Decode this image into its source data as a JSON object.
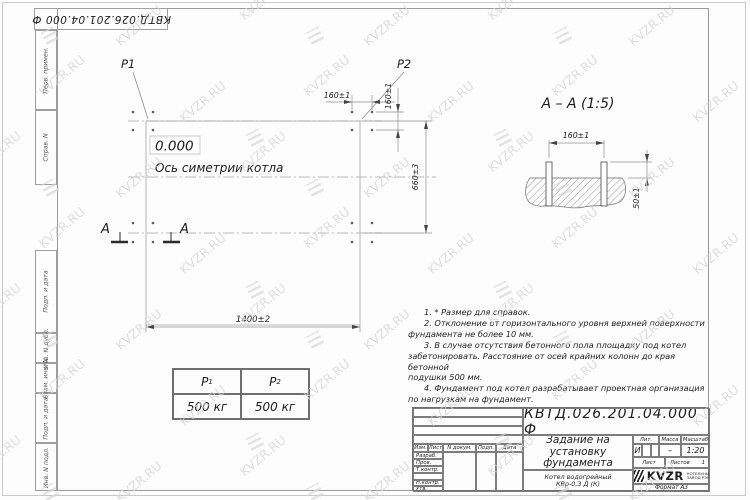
{
  "sheet": {
    "stamp_top": "КВТД.026.201.04.000  Ф",
    "watermark_text": "KVZR.RU"
  },
  "margin": {
    "items": [
      {
        "label": "Перв. примен."
      },
      {
        "label": "Справ. N"
      },
      {
        "label": "Подп. и дата"
      },
      {
        "label": "Инв. N дубл."
      },
      {
        "label": "Взам. инв. N"
      },
      {
        "label": "Подп. и дата"
      },
      {
        "label": "Инв. N подл."
      }
    ]
  },
  "plan": {
    "p1_label": "P1",
    "p2_label": "P2",
    "level_mark": "0.000",
    "axis_label": "Ось симетрии котла",
    "dim_width": "1400±2",
    "dim_height": "660±3",
    "dim_bolt_top": "160±1",
    "dim_bolt_side": "160±1",
    "section_letter": "A"
  },
  "section": {
    "title": "А – А (1:5)",
    "dim_spacing": "160±1",
    "dim_protrusion": "50±1"
  },
  "notes": {
    "lines": [
      "1. * Размер для справок.",
      "2. Отклонение от горизонтального уровня верхней поверхности",
      "фундамента не более 10 мм.",
      "3. В случае отсутствия бетонного пола площадку под котел",
      "забетонировать. Расстояние от осей крайних колонн до края бетонной",
      "подушки 500 мм.",
      "4. Фундамент под котел разрабатывает проектная организация",
      "по нагрузкам на фундамент."
    ]
  },
  "load_table": {
    "col1_base": "P",
    "col1_sub": "1",
    "col2_base": "P",
    "col2_sub": "2",
    "col1_value": "500 кг",
    "col2_value": "500 кг"
  },
  "title_block": {
    "designation": "КВТД.026.201.04.000  Ф",
    "doc_title_line1": "Задание на",
    "doc_title_line2": "установку",
    "doc_title_line3": "фундамента",
    "product_line1": "Котел водогрейный",
    "product_line2": "КВр-0,3 Д (К)",
    "col_izm": "Изм.",
    "col_list": "Лист",
    "col_ndoc": "N докум.",
    "col_podp": "Подп.",
    "col_data": "Дата",
    "row_razrab": "Разраб.",
    "row_prov": "Пров.",
    "row_tkontr": "Т.контр.",
    "row_nkontr": "Н.контр.",
    "row_utv": "Утв.",
    "lit_label": "Лит.",
    "lit_value": "И",
    "mass_label": "Масса",
    "mass_value": "–",
    "scale_label": "Масштаб",
    "scale_value": "1:20",
    "sheet_label": "Лист",
    "sheets_label": "Листов",
    "sheets_value": "1",
    "logo_name": "KVZR",
    "logo_sub1": "КОТЕЛЬНЫЙ",
    "logo_sub2": "ЗАВОД РЭУ",
    "format_label": "Формат А3"
  }
}
